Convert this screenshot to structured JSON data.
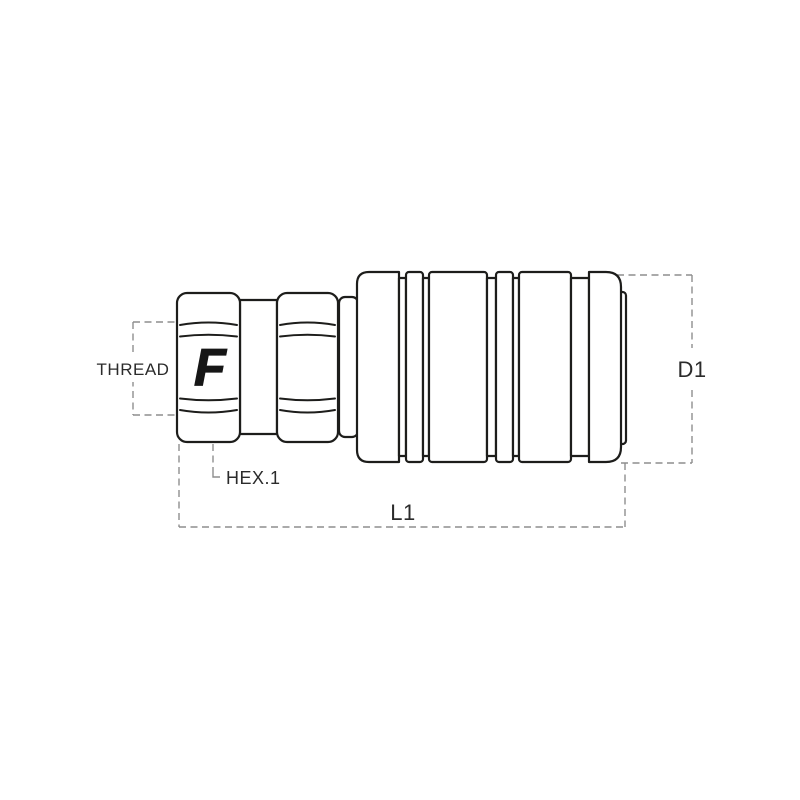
{
  "drawing": {
    "type": "technical-line-drawing",
    "subject": "hydraulic quick-release coupling, side view",
    "logo_letter": "F",
    "dimension_labels": {
      "thread": "THREAD",
      "hex": "HEX.1",
      "length": "L1",
      "diameter": "D1"
    },
    "colors": {
      "outline": "#1d1d1b",
      "dimension_line": "#8e8e8e",
      "label_text": "#2b2b2b",
      "logo": "#161616",
      "background": "#ffffff"
    }
  }
}
